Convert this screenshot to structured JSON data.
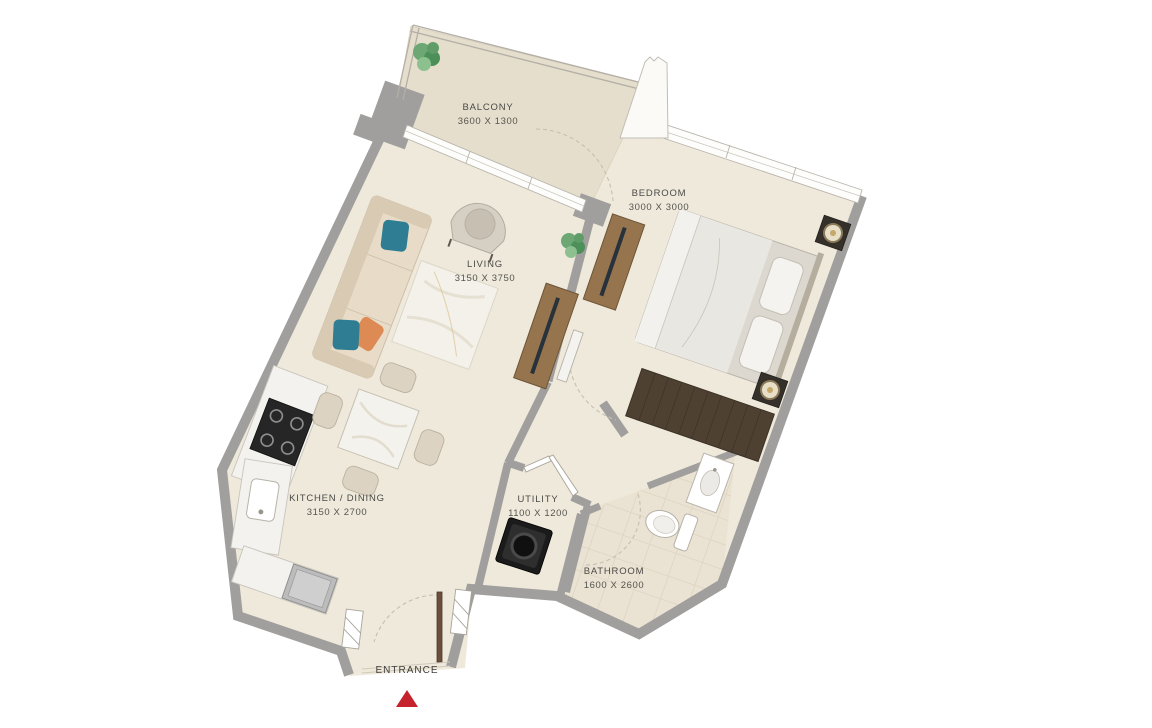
{
  "plan": {
    "title": "apartment-floor-plan",
    "rooms": [
      {
        "name": "BALCONY",
        "dims": "3600 X 1300"
      },
      {
        "name": "BEDROOM",
        "dims": "3000 X 3000"
      },
      {
        "name": "LIVING",
        "dims": "3150 X 3750"
      },
      {
        "name": "KITCHEN / DINING",
        "dims": "3150 X 2700"
      },
      {
        "name": "UTILITY",
        "dims": "1100 X 1200"
      },
      {
        "name": "BATHROOM",
        "dims": "1600 X 2600"
      }
    ],
    "entrance_label": "ENTRANCE",
    "marker_color": "#c5242e",
    "colors": {
      "wall": "#a09f9d",
      "floor": "#efe9db",
      "balcony_floor": "#e5decc",
      "bathroom_floor": "#eae2d2",
      "wood": "#96744d",
      "dark_wood": "#4f4132",
      "accent_teal": "#2e7d92",
      "accent_orange": "#dd8a55",
      "plant_green": "#5f9c68"
    }
  }
}
